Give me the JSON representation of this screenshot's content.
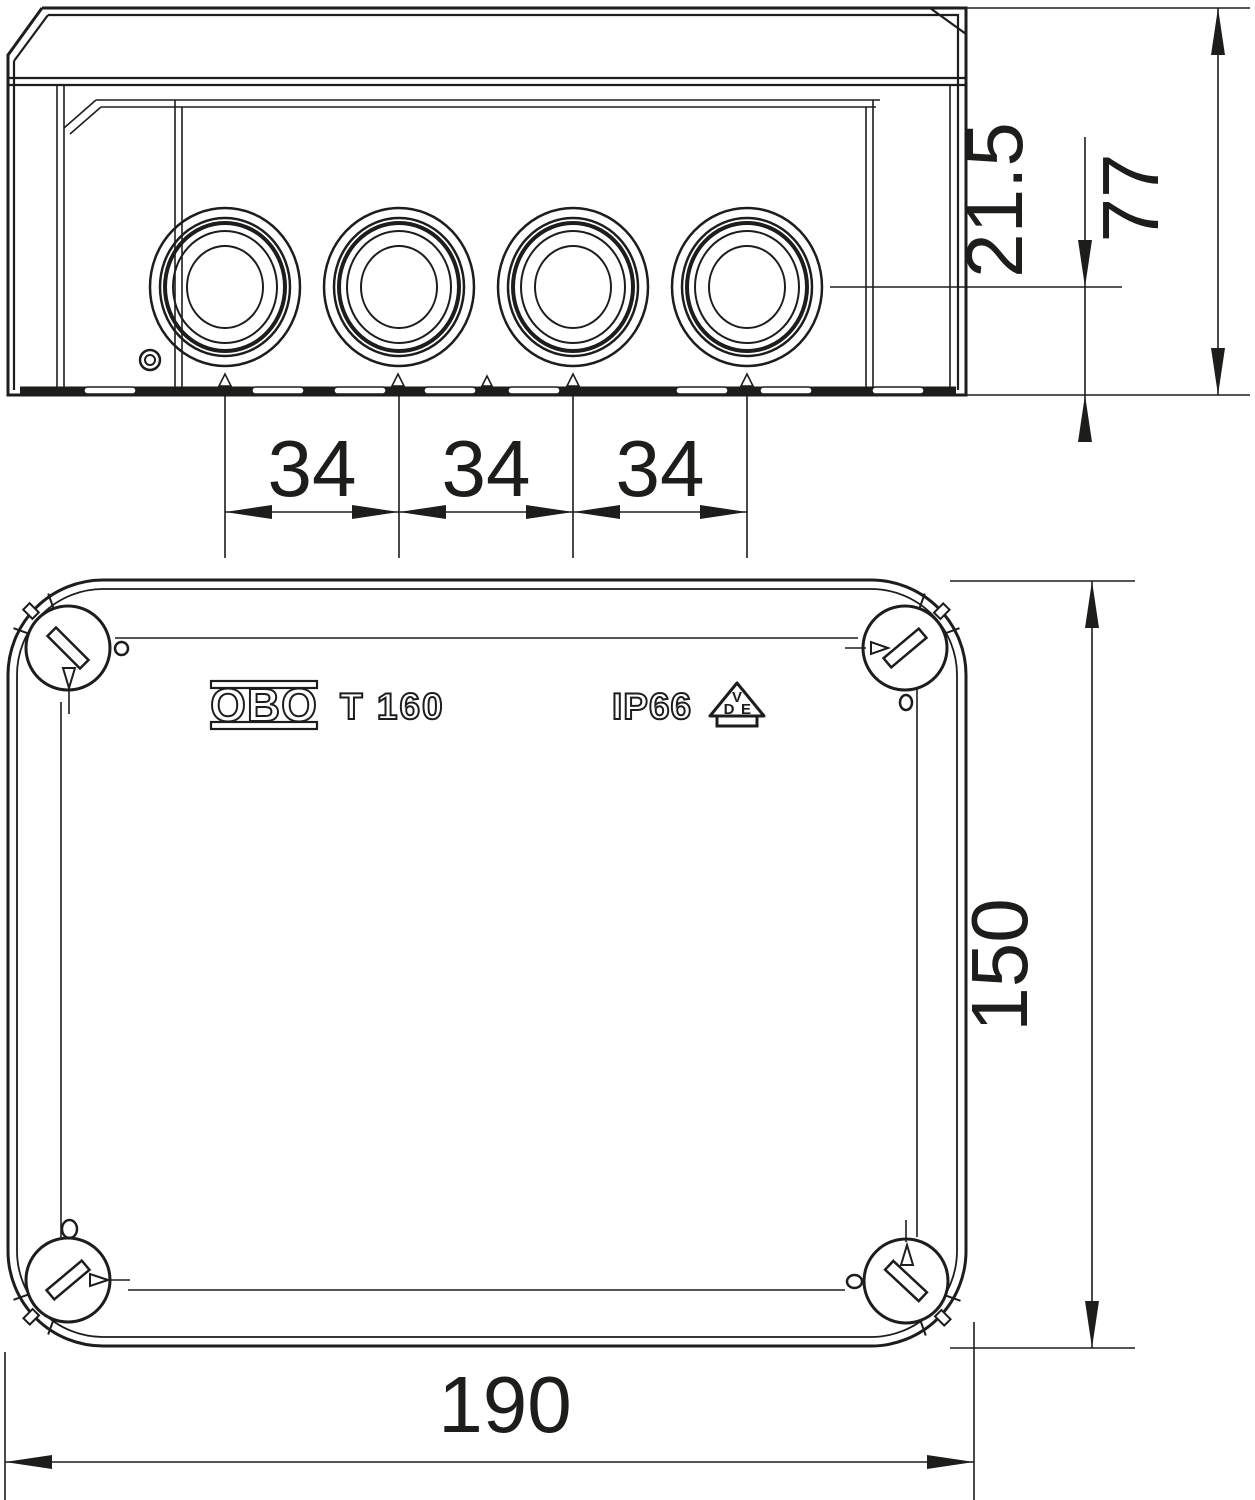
{
  "side_view": {
    "spacing_labels": [
      "34",
      "34",
      "34"
    ],
    "entry_depth_label": "21.5",
    "height_label": "77"
  },
  "top_view": {
    "brand": "OBO",
    "model": "T 160",
    "rating": "IP66",
    "vde_letters": [
      "V",
      "D",
      "E"
    ],
    "length_label": "150",
    "width_label": "190"
  },
  "colors": {
    "line": "#1d1d1b",
    "background": "#ffffff"
  }
}
